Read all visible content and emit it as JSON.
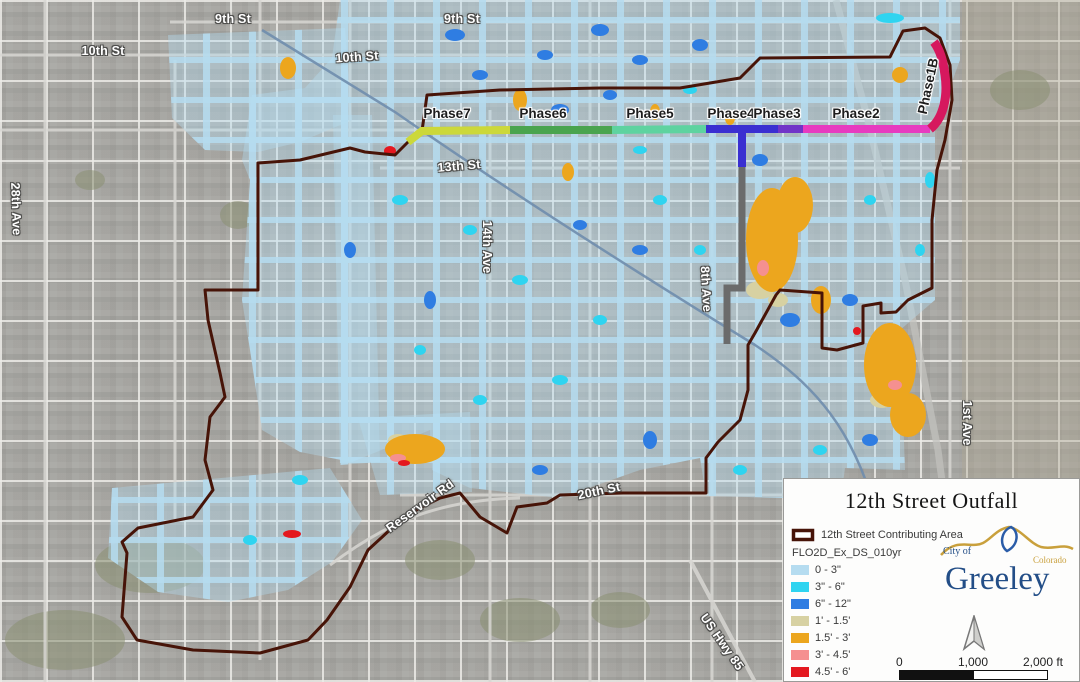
{
  "map": {
    "street_labels": [
      {
        "text": "9th St"
      },
      {
        "text": "9th St"
      },
      {
        "text": "10th St"
      },
      {
        "text": "10th St"
      },
      {
        "text": "13th St"
      },
      {
        "text": "14th Ave"
      },
      {
        "text": "28th Ave"
      },
      {
        "text": "8th Ave"
      },
      {
        "text": "20th St"
      },
      {
        "text": "Reservoir Rd"
      },
      {
        "text": "US Hwy 85"
      },
      {
        "text": "1st Ave"
      }
    ],
    "pipe_color": "#6b6b6b",
    "railroad_color": "#6f8dad"
  },
  "phases": [
    {
      "name": "Phase1B",
      "color": "#d6185e"
    },
    {
      "name": "Phase2",
      "color": "#e73bc0"
    },
    {
      "name": "Phase3",
      "color": "#7134c8"
    },
    {
      "name": "Phase4",
      "color": "#3a2fd1"
    },
    {
      "name": "Phase5",
      "color": "#5ed3a0"
    },
    {
      "name": "Phase6",
      "color": "#4aa44f"
    },
    {
      "name": "Phase7",
      "color": "#ccd83a"
    }
  ],
  "legend": {
    "title": "12th Street Outfall",
    "contributing_area_label": "12th Street Contributing Area",
    "contributing_area_color": "#471408",
    "layer_name": "FLO2D_Ex_DS_010yr",
    "items": [
      {
        "label": "0 - 3\"",
        "color": "#b5dcf0"
      },
      {
        "label": "3\" - 6\"",
        "color": "#2fd4f0"
      },
      {
        "label": "6\" - 12\"",
        "color": "#2f7de2"
      },
      {
        "label": "1' - 1.5'",
        "color": "#d7d1a2"
      },
      {
        "label": "1.5' - 3'",
        "color": "#eca61e"
      },
      {
        "label": "3' - 4.5'",
        "color": "#f59090"
      },
      {
        "label": "4.5' - 6'",
        "color": "#e4181f"
      }
    ],
    "scale": {
      "zero": "0",
      "mid": "1,000",
      "end": "2,000 ft"
    },
    "logo": {
      "city_of": "City of",
      "name": "Greeley",
      "state": "Colorado"
    }
  }
}
